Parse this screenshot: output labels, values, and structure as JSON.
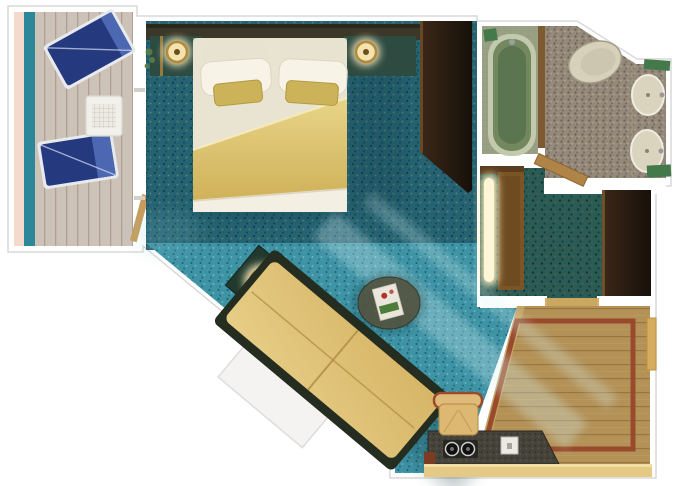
{
  "scene": {
    "type": "cruise-stateroom-floor-plan",
    "rooms": [
      {
        "name": "balcony",
        "furniture": [
          "lounge-chair",
          "lounge-chair",
          "side-table",
          "sliding-door",
          "railing"
        ]
      },
      {
        "name": "bedroom",
        "furniture": [
          "king-bed",
          "white-pillows",
          "gold-accent-pillows",
          "gold-blanket",
          "headboard",
          "nightstand-lamp-left",
          "nightstand-lamp-right",
          "plant",
          "wardrobe"
        ]
      },
      {
        "name": "sitting-area",
        "furniture": [
          "sofa",
          "end-table-lamp",
          "coffee-table",
          "magazine",
          "pullman-panel"
        ]
      },
      {
        "name": "bathroom",
        "furniture": [
          "bathtub",
          "toilet",
          "sink",
          "sink",
          "green-mats",
          "bathroom-door"
        ]
      },
      {
        "name": "hallway",
        "furniture": [
          "lighted-closet",
          "wardrobe",
          "threshold"
        ]
      },
      {
        "name": "entry-foyer",
        "furniture": [
          "wood-floor",
          "inlay-rug-border",
          "desk",
          "desk-chair",
          "cabinet",
          "entry-door"
        ]
      }
    ]
  },
  "palette": {
    "wall": "#ffffff",
    "outline": "#d9d9d9",
    "hull-pink": "#f3dacd",
    "rail-teal": "#2c8799",
    "deck": "#cdc2b8",
    "deck-line": "#af9f94",
    "lounger-blue": "#25397f",
    "lounger-blue-light": "#4d68b2",
    "lounger-frame": "#e9eaee",
    "carpet-bedroom": "#256373",
    "carpet-bedroom-dot": "#143f4a",
    "carpet-fleck-gold": "#b99a55",
    "carpet-sitting": "#3e93a5",
    "carpet-sitting-dot": "#1f5f6d",
    "carpet-sitting-light": "#a4dade",
    "carpet-hall": "#2a5b54",
    "carpet-hall-dot": "#152f29",
    "carpet-hall-fleck": "#7d5f35",
    "headboard": "#3b382a",
    "console-green": "#2e4b42",
    "nightlamp-ring": "#b3893a",
    "lamp-glow": "#ffefbe",
    "bed-sheet": "#f0ebdc",
    "bed-sheet-shadow": "#e2dbc6",
    "blanket-gold": "#e8d489",
    "blanket-gold-deep": "#cfb158",
    "pillow": "#f7f3e7",
    "pillow-back": "#e8e2d1",
    "pillow-gold": "#ccb258",
    "sofa-gold": "#d6b566",
    "sofa-gold-light": "#e7cd86",
    "sofa-base": "#242d1f",
    "end-table": "#223a2e",
    "coffee-table": "#55543f",
    "magazine": "#eae6db",
    "magazine-green": "#4e7d3a",
    "magazine-red": "#b23527",
    "wardrobe-dark": "#17100a",
    "wardrobe-light": "#3b2817",
    "wardrobe-edge": "#6d4b26",
    "closet-wood": "#7c5426",
    "closet-glow-core": "#fff6d8",
    "bath-tile": "#9aa083",
    "bath-tile-line": "#87906e",
    "bath-floor": "#94897a",
    "bath-floor-dot": "#6b6151",
    "bath-floor-light": "#b0a693",
    "tub-rim": "#c3c9ad",
    "tub-fill": "#74885f",
    "tub-water": "#5a7350",
    "toilet": "#d7d1bb",
    "sink": "#dad4bf",
    "fixture-line": "#a39c84",
    "towel-green": "#44794c",
    "wood-floor": "#b39157",
    "wood-line": "#97763f",
    "wood-edge-light": "#c9a766",
    "rug-border": "#9a4a2c",
    "desk-granite": "#45433a",
    "desk-granite-dot": "#2b2a23",
    "cabinet-tan": "#e4ca85",
    "cabinet-highlight": "#f4e3a8",
    "desk-red": "#7e3b24",
    "chair-tan": "#dcb873",
    "chair-trim": "#9a4a2c",
    "door-tan": "#d4ad62",
    "bath-door": "#b08347",
    "shadow": "#0b2f36",
    "light-beam": "#d8f3f5"
  }
}
